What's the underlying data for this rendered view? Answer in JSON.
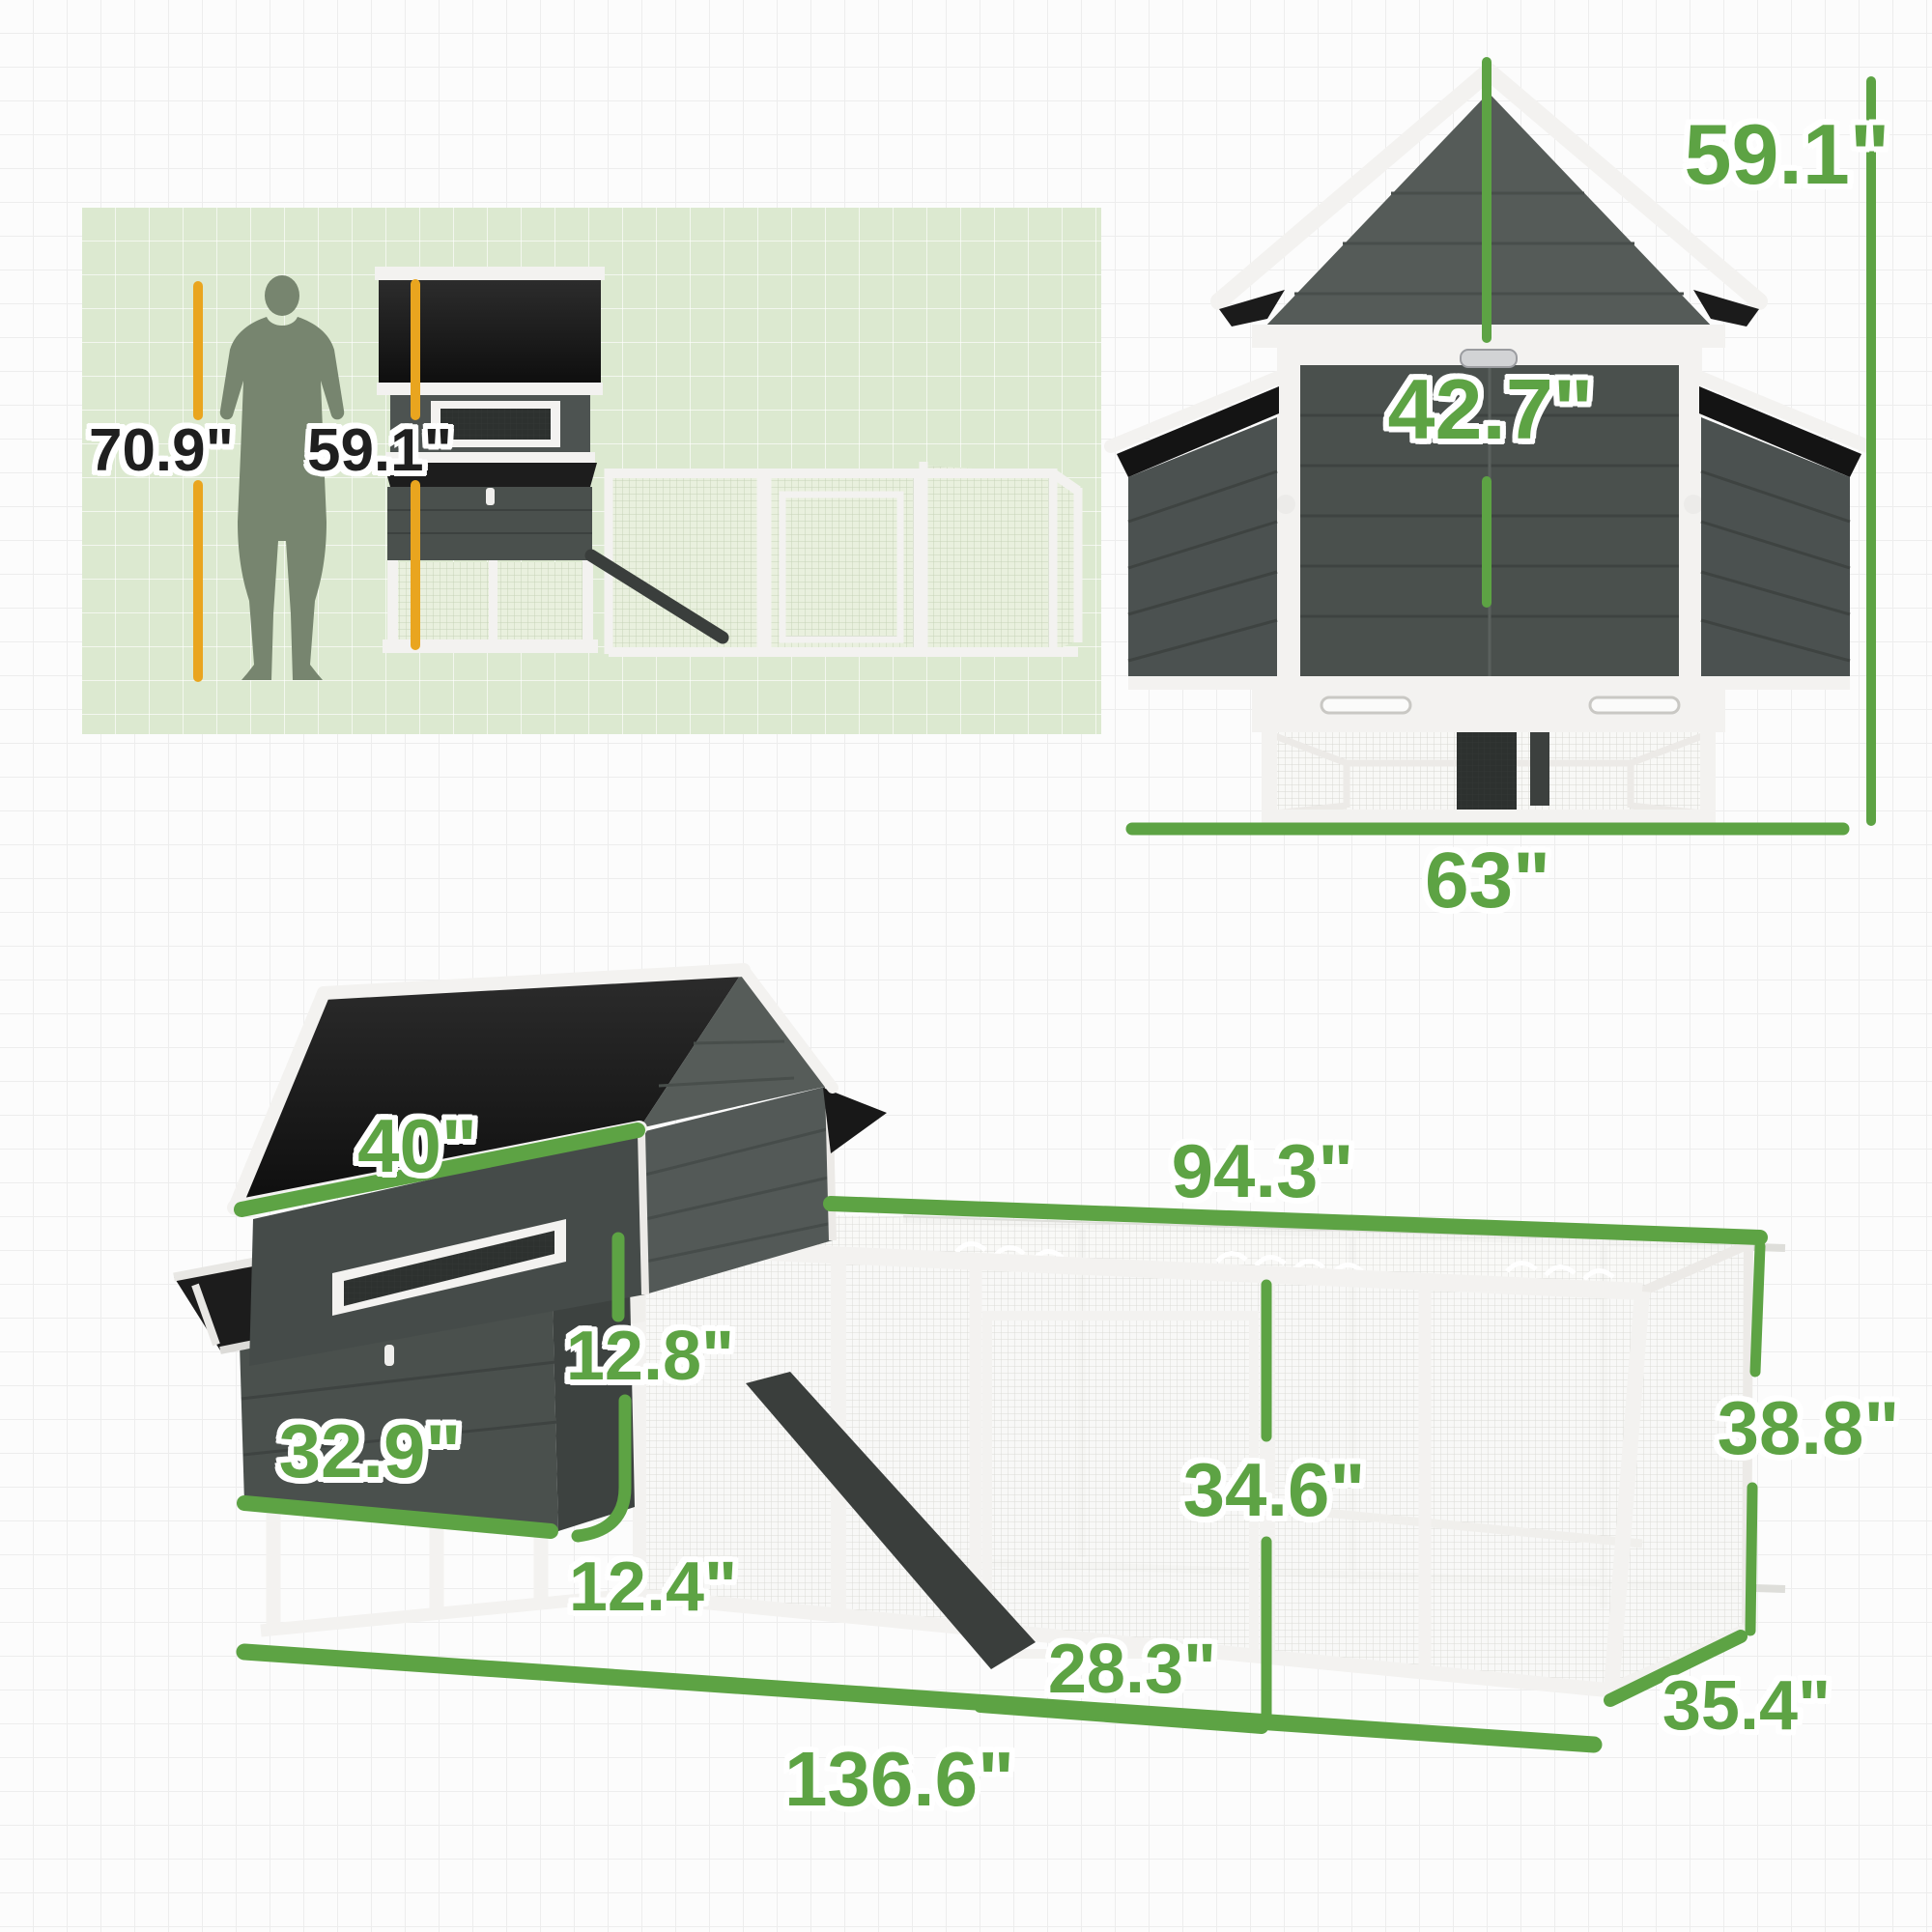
{
  "title": "Chicken coop dimension diagram",
  "colors": {
    "green": "#5da344",
    "orange": "#e9a51f",
    "ink": "#1f1f1f",
    "panel": "#dce9d0",
    "wood-dark": "#474c4a",
    "roof-black": "#161616",
    "frame-white": "#f3f2f0"
  },
  "scale_panel": {
    "human_height": "70.9\"",
    "coop_height": "59.1\""
  },
  "front_view": {
    "total_height": "59.1\"",
    "inner_height": "42.7\"",
    "width": "63\""
  },
  "perspective_view": {
    "roof_width": "40\"",
    "run_top_length": "94.3\"",
    "nestbox_height": "12.8\"",
    "nestbox_width": "32.9\"",
    "nestbox_clearance": "12.4\"",
    "run_inner_height": "34.6\"",
    "door_section_width": "28.3\"",
    "run_height": "38.8\"",
    "total_length": "136.6\"",
    "depth": "35.4\""
  }
}
